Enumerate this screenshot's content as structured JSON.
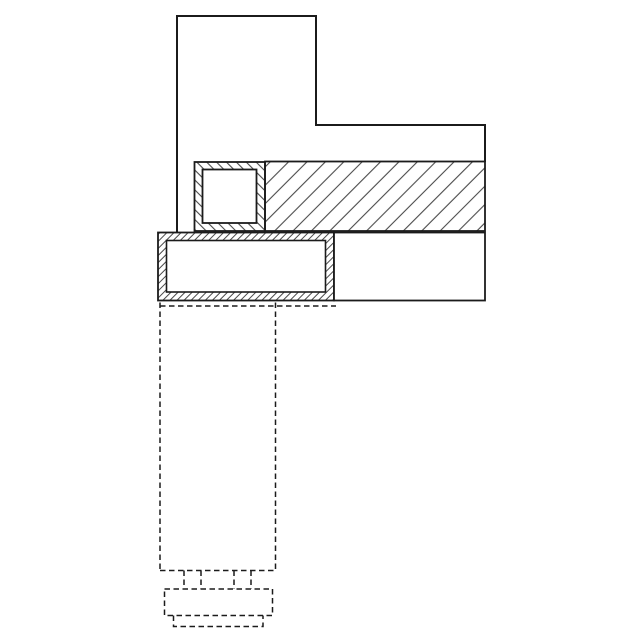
{
  "drawing": {
    "canvas": {
      "width": 640,
      "height": 640,
      "background": "#ffffff"
    },
    "colors": {
      "outline": "#1b1b1b",
      "hatch_line": "#4a4a4a",
      "white_fill": "#ffffff"
    },
    "dash_pattern": "5.5 3.5",
    "hatches": [
      {
        "id": "hatch-slab",
        "angle": 45,
        "spacing": 13,
        "stroke_width": 1.1
      },
      {
        "id": "hatch-block",
        "angle": -45,
        "spacing": 7,
        "stroke_width": 1.1
      },
      {
        "id": "hatch-tube",
        "angle": 45,
        "spacing": 5,
        "stroke_width": 1.0
      }
    ],
    "shapes": [
      {
        "name": "upper-profile-outline",
        "type": "polyline",
        "points": "177,232.5 177,16 316,16 316,125 485,125 485,162",
        "fill": "none",
        "stroke_width": 2
      },
      {
        "name": "hatched-slab",
        "type": "rect",
        "x": 265,
        "y": 161.5,
        "w": 220,
        "h": 69.5,
        "hatch": "hatch-slab",
        "stroke_width": 1.8
      },
      {
        "name": "square-tube-wall-hatched",
        "type": "rect",
        "x": 194.5,
        "y": 162,
        "w": 70.5,
        "h": 69,
        "hatch": "hatch-block",
        "stroke_width": 1.8
      },
      {
        "name": "square-tube-bore",
        "type": "rect",
        "x": 202.5,
        "y": 169.5,
        "w": 54,
        "h": 53.5,
        "fill": "white",
        "stroke_width": 1.8
      },
      {
        "name": "rect-tube-wall-hatched",
        "type": "rect",
        "x": 158,
        "y": 232.5,
        "w": 176,
        "h": 68,
        "hatch": "hatch-tube",
        "stroke_width": 1.8
      },
      {
        "name": "rect-tube-bore",
        "type": "rect",
        "x": 166.5,
        "y": 240.5,
        "w": 159,
        "h": 51.5,
        "fill": "white",
        "stroke_width": 1.6
      },
      {
        "name": "right-frame-rect",
        "type": "rect",
        "x": 334,
        "y": 232.5,
        "w": 151,
        "h": 68,
        "fill": "white",
        "stroke_width": 1.8
      },
      {
        "name": "hidden-left-edge",
        "type": "line",
        "x1": 160,
        "y1": 302.5,
        "x2": 160,
        "y2": 570.5,
        "dash": true
      },
      {
        "name": "hidden-right-edge",
        "type": "line",
        "x1": 275.5,
        "y1": 302.5,
        "x2": 275.5,
        "y2": 570.5,
        "dash": true
      },
      {
        "name": "hidden-top-edge",
        "type": "line",
        "x1": 160,
        "y1": 306,
        "x2": 336,
        "y2": 306,
        "dash": true
      },
      {
        "name": "hidden-bottom-edge",
        "type": "line",
        "x1": 160,
        "y1": 570.5,
        "x2": 275.5,
        "y2": 570.5,
        "dash": true
      },
      {
        "name": "hidden-tab-1-left",
        "type": "line",
        "x1": 184,
        "y1": 570.5,
        "x2": 184,
        "y2": 589,
        "dash": true
      },
      {
        "name": "hidden-tab-1-right",
        "type": "line",
        "x1": 201,
        "y1": 570.5,
        "x2": 201,
        "y2": 589,
        "dash": true
      },
      {
        "name": "hidden-tab-2-left",
        "type": "line",
        "x1": 234,
        "y1": 570.5,
        "x2": 234,
        "y2": 589,
        "dash": true
      },
      {
        "name": "hidden-tab-2-right",
        "type": "line",
        "x1": 251,
        "y1": 570.5,
        "x2": 251,
        "y2": 589,
        "dash": true
      },
      {
        "name": "hidden-base-plate",
        "type": "rect",
        "x": 164.5,
        "y": 589,
        "w": 108,
        "h": 26.5,
        "fill": "none",
        "dash": true,
        "stroke_width": 1.5
      },
      {
        "name": "hidden-foot",
        "type": "polyline",
        "points": "173.5,615.5 173.5,626.5 263,626.5 263,615.5",
        "fill": "none",
        "dash": true,
        "stroke_width": 1.5
      }
    ]
  }
}
